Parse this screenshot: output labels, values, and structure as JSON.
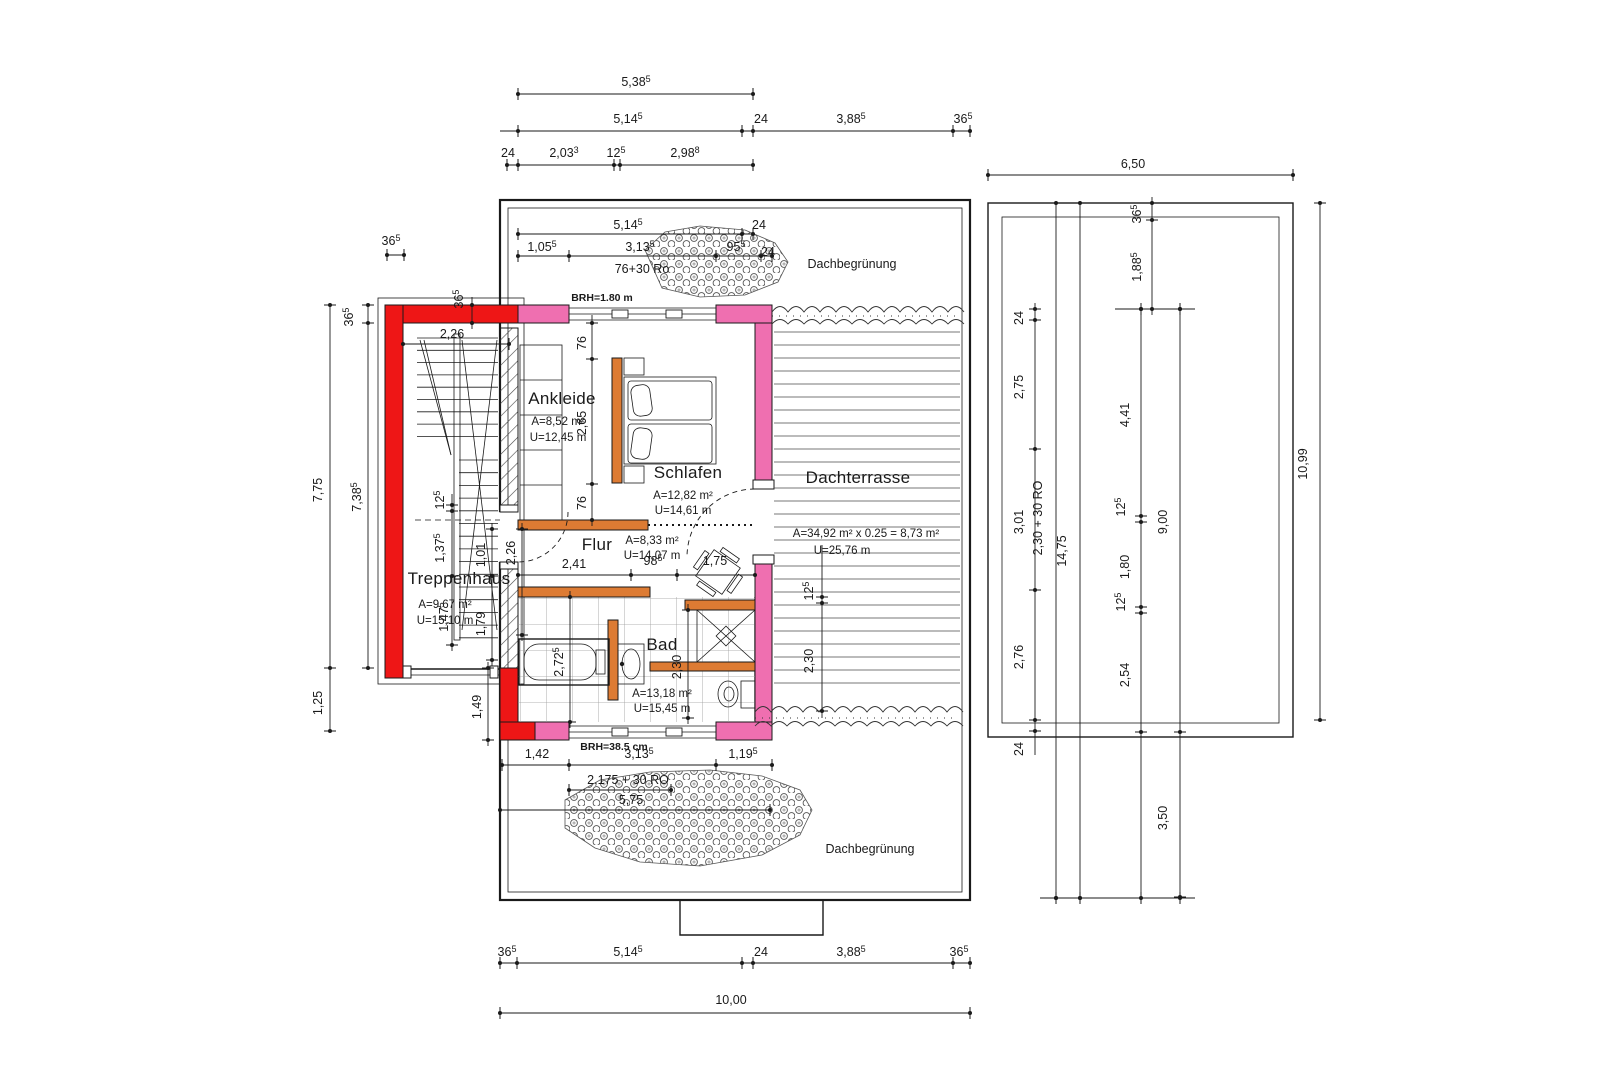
{
  "drawing_type": "floor-plan (Dachgeschoss / attic storey, German architectural drawing)",
  "colors": {
    "wall_red": "#ee1616",
    "wall_pink": "#ef6fb0",
    "wall_orange": "#dd7b33",
    "line": "#1a1a1a",
    "tile": "#9a9a9a",
    "deck": "#4a4a4a"
  },
  "drawing": {
    "rooms": [
      {
        "name": "Treppenhaus",
        "area": "A=9,67 m²",
        "perimeter": "U=15,10 m",
        "nx": 459,
        "ny": 584,
        "ax": 445,
        "ay": 608,
        "ux": 445,
        "uy": 624
      },
      {
        "name": "Ankleide",
        "area": "A=8,52 m²",
        "perimeter": "U=12,45 m",
        "nx": 562,
        "ny": 404,
        "ax": 558,
        "ay": 425,
        "ux": 558,
        "uy": 441
      },
      {
        "name": "Schlafen",
        "area": "A=12,82 m²",
        "perimeter": "U=14,61 m",
        "nx": 688,
        "ny": 478,
        "ax": 683,
        "ay": 499,
        "ux": 683,
        "uy": 514
      },
      {
        "name": "Flur",
        "area": "A=8,33 m²",
        "perimeter": "U=14,07 m",
        "nx": 597,
        "ny": 550,
        "ax": 652,
        "ay": 544,
        "ux": 652,
        "uy": 559
      },
      {
        "name": "Bad",
        "area": "A=13,18 m²",
        "perimeter": "U=15,45 m",
        "nx": 662,
        "ny": 650,
        "ax": 662,
        "ay": 697,
        "ux": 662,
        "uy": 712
      },
      {
        "name": "Dachterrasse",
        "area": "A=34,92 m² x 0.25 = 8,73 m²",
        "perimeter": "U=25,76 m",
        "nx": 858,
        "ny": 483,
        "ax": 866,
        "ay": 537,
        "ux": 842,
        "uy": 554
      }
    ],
    "annotations": [
      {
        "t": "Dachbegrünung",
        "x": 852,
        "y": 268,
        "cls": "anno"
      },
      {
        "t": "Dachbegrünung",
        "x": 870,
        "y": 853,
        "cls": "anno"
      },
      {
        "t": "76+30 Ro",
        "x": 642,
        "y": 273,
        "cls": "anno"
      },
      {
        "t": "BRH=1.80 m",
        "x": 602,
        "y": 301,
        "cls": "tiny"
      },
      {
        "t": "BRH=38.5 cm",
        "x": 614,
        "y": 750,
        "cls": "tiny"
      },
      {
        "t": "2,175 + 30 RO",
        "x": 628,
        "y": 784,
        "cls": "anno"
      },
      {
        "t": "2,30 + 30 RO",
        "x": 1042,
        "y": 518,
        "cls": "anno",
        "rot": 1
      },
      {
        "t": "14,75",
        "x": 1066,
        "y": 551,
        "cls": "dim",
        "rot": 1
      }
    ],
    "dims": [
      {
        "t": "5,38",
        "sup": "5",
        "x": 636,
        "y": 86
      },
      {
        "t": "5,14",
        "sup": "5",
        "x": 628,
        "y": 123
      },
      {
        "t": "24",
        "x": 761,
        "y": 123
      },
      {
        "t": "3,88",
        "sup": "5",
        "x": 851,
        "y": 123
      },
      {
        "t": "36",
        "sup": "5",
        "x": 963,
        "y": 123
      },
      {
        "t": "24",
        "x": 508,
        "y": 157
      },
      {
        "t": "2,03",
        "sup": "3",
        "x": 564,
        "y": 157
      },
      {
        "t": "12",
        "sup": "5",
        "x": 616,
        "y": 157
      },
      {
        "t": "2,98",
        "sup": "8",
        "x": 685,
        "y": 157
      },
      {
        "t": "5,14",
        "sup": "5",
        "x": 628,
        "y": 229
      },
      {
        "t": "24",
        "x": 759,
        "y": 229
      },
      {
        "t": "1,05",
        "sup": "5",
        "x": 542,
        "y": 251
      },
      {
        "t": "3,13",
        "sup": "5",
        "x": 640,
        "y": 251
      },
      {
        "t": "95",
        "sup": "5",
        "x": 736,
        "y": 251
      },
      {
        "t": "24",
        "x": 768,
        "y": 256
      },
      {
        "t": "36",
        "sup": "5",
        "x": 391,
        "y": 245
      },
      {
        "t": "36",
        "sup": "5",
        "x": 463,
        "y": 299,
        "rot": 1
      },
      {
        "t": "36",
        "sup": "5",
        "x": 353,
        "y": 317,
        "rot": 1
      },
      {
        "t": "7,75",
        "x": 322,
        "y": 490,
        "rot": 1
      },
      {
        "t": "7,38",
        "sup": "5",
        "x": 361,
        "y": 497,
        "rot": 1
      },
      {
        "t": "1,25",
        "x": 322,
        "y": 703,
        "rot": 1
      },
      {
        "t": "2,26",
        "x": 452,
        "y": 338
      },
      {
        "t": "76",
        "x": 586,
        "y": 343,
        "rot": 1
      },
      {
        "t": "2,65",
        "x": 586,
        "y": 423,
        "rot": 1
      },
      {
        "t": "76",
        "x": 586,
        "y": 503,
        "rot": 1
      },
      {
        "t": "12",
        "sup": "5",
        "x": 444,
        "y": 500,
        "rot": 1
      },
      {
        "t": "1,37",
        "sup": "5",
        "x": 444,
        "y": 548,
        "rot": 1
      },
      {
        "t": "1,47",
        "sup": "5",
        "x": 448,
        "y": 617,
        "rot": 1
      },
      {
        "t": "1,01",
        "x": 485,
        "y": 555,
        "rot": 1
      },
      {
        "t": "1,79",
        "x": 485,
        "y": 624,
        "rot": 1
      },
      {
        "t": "2,26",
        "x": 515,
        "y": 553,
        "rot": 1
      },
      {
        "t": "2,41",
        "x": 574,
        "y": 568
      },
      {
        "t": "98",
        "sup": "5",
        "x": 653,
        "y": 565
      },
      {
        "t": "1,75",
        "x": 715,
        "y": 565
      },
      {
        "t": "2,72",
        "sup": "5",
        "x": 563,
        "y": 662,
        "rot": 1
      },
      {
        "t": "2,30",
        "x": 681,
        "y": 667,
        "rot": 1
      },
      {
        "t": "12",
        "sup": "5",
        "x": 813,
        "y": 591,
        "rot": 1
      },
      {
        "t": "2,30",
        "x": 813,
        "y": 661,
        "rot": 1
      },
      {
        "t": "1,42",
        "x": 537,
        "y": 758
      },
      {
        "t": "3,13",
        "sup": "5",
        "x": 639,
        "y": 758
      },
      {
        "t": "1,19",
        "sup": "5",
        "x": 743,
        "y": 758
      },
      {
        "t": "5,75",
        "x": 631,
        "y": 804
      },
      {
        "t": "1,49",
        "x": 481,
        "y": 707,
        "rot": 1
      },
      {
        "t": "36",
        "sup": "5",
        "x": 507,
        "y": 956
      },
      {
        "t": "5,14",
        "sup": "5",
        "x": 628,
        "y": 956
      },
      {
        "t": "24",
        "x": 761,
        "y": 956
      },
      {
        "t": "3,88",
        "sup": "5",
        "x": 851,
        "y": 956
      },
      {
        "t": "36",
        "sup": "5",
        "x": 959,
        "y": 956
      },
      {
        "t": "10,00",
        "x": 731,
        "y": 1004
      },
      {
        "t": "6,50",
        "x": 1133,
        "y": 168
      },
      {
        "t": "36",
        "sup": "5",
        "x": 1141,
        "y": 214,
        "rot": 1
      },
      {
        "t": "1,88",
        "sup": "5",
        "x": 1141,
        "y": 267,
        "rot": 1
      },
      {
        "t": "24",
        "x": 1023,
        "y": 318,
        "rot": 1
      },
      {
        "t": "2,75",
        "x": 1023,
        "y": 387,
        "rot": 1
      },
      {
        "t": "3,01",
        "x": 1023,
        "y": 522,
        "rot": 1
      },
      {
        "t": "2,76",
        "x": 1023,
        "y": 657,
        "rot": 1
      },
      {
        "t": "24",
        "x": 1023,
        "y": 749,
        "rot": 1
      },
      {
        "t": "4,41",
        "x": 1129,
        "y": 415,
        "rot": 1
      },
      {
        "t": "12",
        "sup": "5",
        "x": 1125,
        "y": 507,
        "rot": 1
      },
      {
        "t": "1,80",
        "x": 1129,
        "y": 567,
        "rot": 1
      },
      {
        "t": "12",
        "sup": "5",
        "x": 1125,
        "y": 602,
        "rot": 1
      },
      {
        "t": "2,54",
        "x": 1129,
        "y": 675,
        "rot": 1
      },
      {
        "t": "9,00",
        "x": 1167,
        "y": 522,
        "rot": 1
      },
      {
        "t": "3,50",
        "x": 1167,
        "y": 818,
        "rot": 1
      },
      {
        "t": "10,99",
        "x": 1307,
        "y": 464,
        "rot": 1
      }
    ],
    "dim_lines_h": [
      {
        "y": 94,
        "x1": 518,
        "x2": 753,
        "t": [
          518,
          753
        ]
      },
      {
        "y": 131,
        "x1": 500,
        "x2": 970,
        "t": [
          518,
          742,
          753,
          953,
          970
        ]
      },
      {
        "y": 165,
        "x1": 507,
        "x2": 753,
        "t": [
          507,
          518,
          614,
          620,
          753
        ]
      },
      {
        "y": 234,
        "x1": 518,
        "x2": 753,
        "t": [
          518,
          742,
          753
        ]
      },
      {
        "y": 256,
        "x1": 518,
        "x2": 772,
        "t": [
          518,
          569,
          716,
          761,
          772
        ]
      },
      {
        "y": 255,
        "x1": 387,
        "x2": 404,
        "t": [
          387,
          404
        ]
      },
      {
        "y": 344,
        "x1": 403,
        "x2": 509,
        "t": [
          403,
          509
        ]
      },
      {
        "y": 575,
        "x1": 518,
        "x2": 755,
        "t": [
          518,
          631,
          677,
          755
        ]
      },
      {
        "y": 765,
        "x1": 502,
        "x2": 772,
        "t": [
          502,
          569,
          716,
          772
        ]
      },
      {
        "y": 790,
        "x1": 569,
        "x2": 671,
        "t": [
          569,
          671
        ]
      },
      {
        "y": 810,
        "x1": 500,
        "x2": 770,
        "t": [
          500,
          770
        ]
      },
      {
        "y": 963,
        "x1": 500,
        "x2": 970,
        "t": [
          500,
          517,
          742,
          753,
          953,
          970
        ]
      },
      {
        "y": 1013,
        "x1": 500,
        "x2": 970,
        "t": [
          500,
          970
        ]
      },
      {
        "y": 175,
        "x1": 988,
        "x2": 1293,
        "t": [
          988,
          1293
        ]
      },
      {
        "y": 309,
        "x1": 1115,
        "x2": 1195,
        "t": [
          1141,
          1180
        ]
      },
      {
        "y": 898,
        "x1": 1040,
        "x2": 1195,
        "t": [
          1056,
          1080,
          1141,
          1180
        ]
      }
    ],
    "dim_lines_v": [
      {
        "x": 330,
        "y1": 305,
        "y2": 731,
        "t": [
          305,
          668,
          731
        ]
      },
      {
        "x": 368,
        "y1": 305,
        "y2": 668,
        "t": [
          305,
          323,
          668
        ]
      },
      {
        "x": 472,
        "y1": 297,
        "y2": 329,
        "t": [
          305,
          323
        ]
      },
      {
        "x": 592,
        "y1": 315,
        "y2": 526,
        "t": [
          323,
          359,
          484,
          520
        ]
      },
      {
        "x": 452,
        "y1": 494,
        "y2": 651,
        "t": [
          505,
          511,
          576,
          645
        ]
      },
      {
        "x": 492,
        "y1": 523,
        "y2": 666,
        "t": [
          529,
          576,
          660
        ]
      },
      {
        "x": 522,
        "y1": 523,
        "y2": 641,
        "t": [
          529,
          635
        ]
      },
      {
        "x": 570,
        "y1": 591,
        "y2": 728,
        "t": [
          597,
          722
        ]
      },
      {
        "x": 688,
        "y1": 604,
        "y2": 724,
        "t": [
          610,
          718
        ]
      },
      {
        "x": 822,
        "y1": 545,
        "y2": 718,
        "t": [
          597,
          603,
          711
        ]
      },
      {
        "x": 488,
        "y1": 662,
        "y2": 746,
        "t": [
          668,
          740
        ]
      },
      {
        "x": 1035,
        "y1": 303,
        "y2": 755,
        "t": [
          309,
          320,
          449,
          590,
          720,
          731
        ]
      },
      {
        "x": 1056,
        "y1": 203,
        "y2": 898,
        "t": [
          203,
          898
        ]
      },
      {
        "x": 1080,
        "y1": 203,
        "y2": 898,
        "t": [
          203,
          898
        ]
      },
      {
        "x": 1141,
        "y1": 303,
        "y2": 900,
        "t": [
          309,
          516,
          522,
          607,
          613,
          732
        ]
      },
      {
        "x": 1180,
        "y1": 303,
        "y2": 898,
        "t": [
          309,
          732,
          897
        ]
      },
      {
        "x": 1320,
        "y1": 203,
        "y2": 720,
        "t": [
          203,
          720
        ]
      },
      {
        "x": 1152,
        "y1": 197,
        "y2": 315,
        "t": [
          203,
          220,
          309
        ]
      }
    ]
  }
}
